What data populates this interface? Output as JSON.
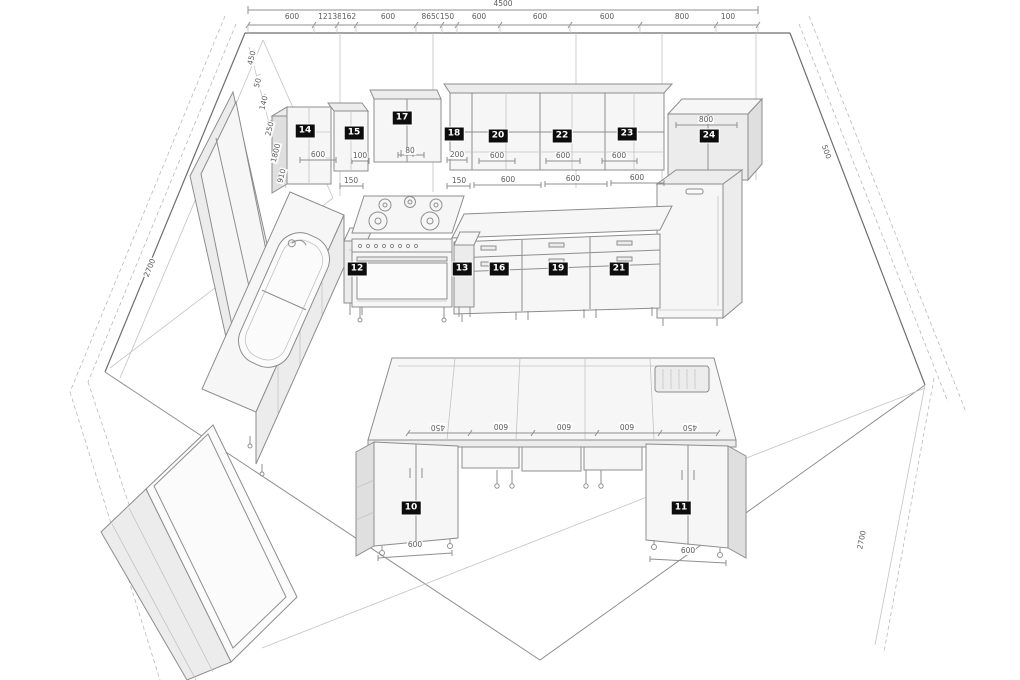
{
  "drawing": {
    "type": "kitchen-3d-perspective-plan",
    "room_total_width": "4500",
    "colors": {
      "background": "#ffffff",
      "line": "#8f8f8f",
      "cabinet_fill": "#f6f6f6",
      "shade_fill": "#dfdfdf",
      "badge_bg": "#0d0d0d",
      "badge_fg": "#ffffff",
      "dim_text": "#5c5c5c"
    }
  },
  "top_dimension": {
    "total": "4500",
    "segments": [
      "600",
      "12138",
      "162",
      "600",
      "8650",
      "150",
      "600",
      "600",
      "600",
      "800",
      "100"
    ]
  },
  "badges": [
    {
      "n": "10",
      "x": 411,
      "y": 508
    },
    {
      "n": "11",
      "x": 681,
      "y": 508
    },
    {
      "n": "12",
      "x": 357,
      "y": 269
    },
    {
      "n": "13",
      "x": 462,
      "y": 269
    },
    {
      "n": "14",
      "x": 305,
      "y": 131
    },
    {
      "n": "15",
      "x": 354,
      "y": 133
    },
    {
      "n": "16",
      "x": 499,
      "y": 269
    },
    {
      "n": "17",
      "x": 402,
      "y": 118
    },
    {
      "n": "18",
      "x": 454,
      "y": 134
    },
    {
      "n": "19",
      "x": 558,
      "y": 269
    },
    {
      "n": "20",
      "x": 498,
      "y": 136
    },
    {
      "n": "21",
      "x": 619,
      "y": 269
    },
    {
      "n": "22",
      "x": 562,
      "y": 136
    },
    {
      "n": "23",
      "x": 627,
      "y": 134
    },
    {
      "n": "24",
      "x": 709,
      "y": 136
    }
  ],
  "dimension_labels": [
    {
      "t": "4500",
      "x": 503,
      "y": 4
    },
    {
      "t": "600",
      "x": 292,
      "y": 17
    },
    {
      "t": "12138",
      "x": 330,
      "y": 17
    },
    {
      "t": "162",
      "x": 349,
      "y": 17
    },
    {
      "t": "600",
      "x": 388,
      "y": 17
    },
    {
      "t": "8650",
      "x": 431,
      "y": 17
    },
    {
      "t": "150",
      "x": 447,
      "y": 17
    },
    {
      "t": "600",
      "x": 479,
      "y": 17
    },
    {
      "t": "600",
      "x": 540,
      "y": 17
    },
    {
      "t": "600",
      "x": 607,
      "y": 17
    },
    {
      "t": "800",
      "x": 682,
      "y": 17
    },
    {
      "t": "100",
      "x": 728,
      "y": 17
    },
    {
      "t": "600",
      "x": 318,
      "y": 155
    },
    {
      "t": "100",
      "x": 360,
      "y": 156
    },
    {
      "t": "80",
      "x": 410,
      "y": 151
    },
    {
      "t": "200",
      "x": 457,
      "y": 155
    },
    {
      "t": "600",
      "x": 497,
      "y": 156
    },
    {
      "t": "600",
      "x": 563,
      "y": 156
    },
    {
      "t": "600",
      "x": 619,
      "y": 156
    },
    {
      "t": "800",
      "x": 706,
      "y": 120
    },
    {
      "t": "150",
      "x": 351,
      "y": 181
    },
    {
      "t": "150",
      "x": 459,
      "y": 181
    },
    {
      "t": "600",
      "x": 508,
      "y": 180
    },
    {
      "t": "600",
      "x": 573,
      "y": 179
    },
    {
      "t": "600",
      "x": 637,
      "y": 178
    },
    {
      "t": "450",
      "x": 438,
      "y": 427,
      "r": 180
    },
    {
      "t": "600",
      "x": 501,
      "y": 426,
      "r": 180
    },
    {
      "t": "600",
      "x": 564,
      "y": 426,
      "r": 180
    },
    {
      "t": "600",
      "x": 627,
      "y": 426,
      "r": 180
    },
    {
      "t": "450",
      "x": 690,
      "y": 427,
      "r": 180
    },
    {
      "t": "600",
      "x": 415,
      "y": 545
    },
    {
      "t": "600",
      "x": 688,
      "y": 551
    },
    {
      "t": "450",
      "x": 252,
      "y": 58,
      "r": -76
    },
    {
      "t": "50",
      "x": 258,
      "y": 83,
      "r": -76
    },
    {
      "t": "140",
      "x": 264,
      "y": 103,
      "r": -76
    },
    {
      "t": "250",
      "x": 270,
      "y": 129,
      "r": -76
    },
    {
      "t": "1800",
      "x": 276,
      "y": 153,
      "r": -76
    },
    {
      "t": "910",
      "x": 282,
      "y": 176,
      "r": -76
    },
    {
      "t": "2700",
      "x": 150,
      "y": 268,
      "r": -68
    },
    {
      "t": "500",
      "x": 826,
      "y": 152,
      "r": 69
    },
    {
      "t": "2700",
      "x": 862,
      "y": 540,
      "r": -79
    }
  ]
}
